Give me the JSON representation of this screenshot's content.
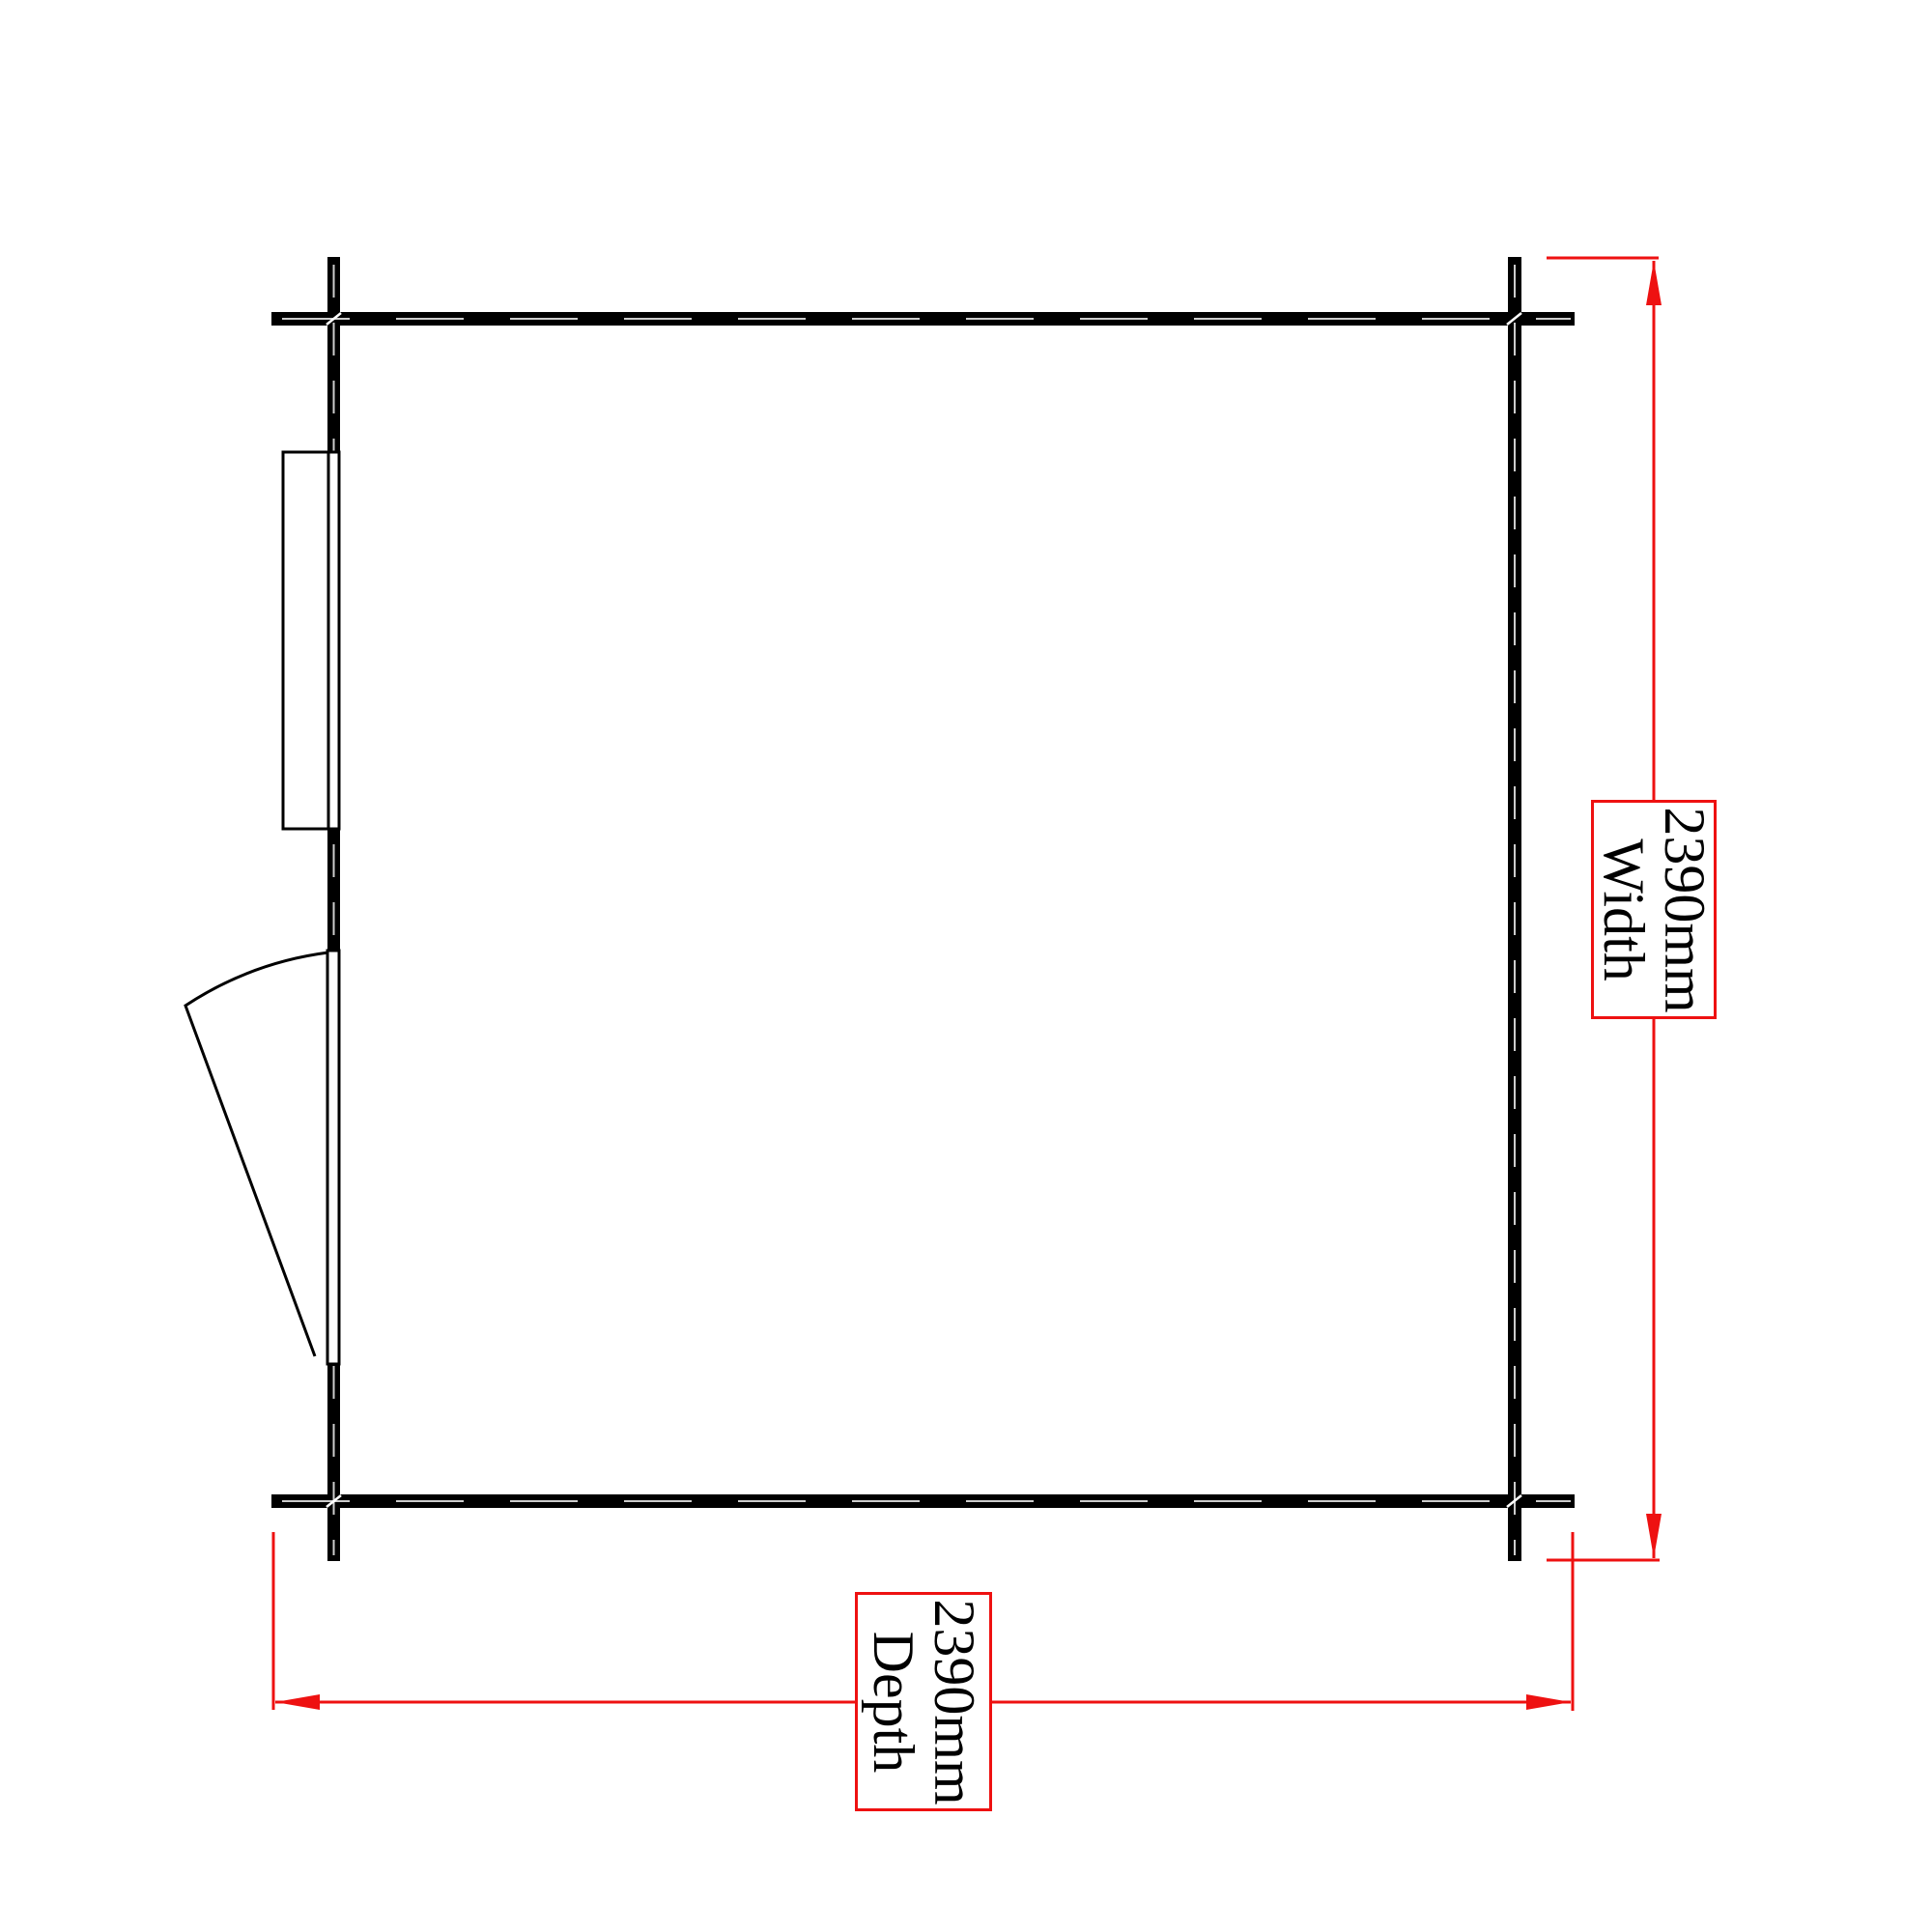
{
  "plan": {
    "type": "floor-plan-top-view",
    "features": [
      "window",
      "door-swing"
    ]
  },
  "dimensions": {
    "width": {
      "value": "2390mm",
      "label": "Width"
    },
    "depth": {
      "value": "2390mm",
      "label": "Depth"
    }
  },
  "colors": {
    "wall": "#000000",
    "dimension": "#ee1111",
    "background": "#ffffff",
    "text": "#000000"
  }
}
